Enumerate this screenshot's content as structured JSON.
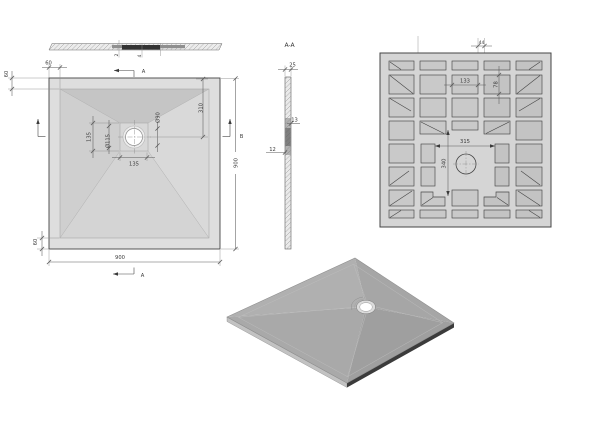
{
  "window": {
    "width": 600,
    "height": 424,
    "background": "#ffffff"
  },
  "colors": {
    "line": "#454545",
    "dim": "#5a5a5a",
    "face-plan": "#dedede",
    "slope-top": "#c5c5c5",
    "slope-left": "#cfcfcf",
    "slope-right": "#d9d9d9",
    "slope-bottom": "#d4d4d4",
    "flat": "#d8d8d8",
    "face-bottom": "#d5d5d5",
    "pocket": "#c9c9c9",
    "pocket-dark": "#c3c3c3",
    "iso-tl": "#b0b0b0",
    "iso-tr": "#a6a6a6",
    "iso-br": "#9f9f9f",
    "iso-bl": "#a9a9a9",
    "iso-edge-light": "#c2c2c2",
    "iso-edge-dark": "#3b3b3b"
  },
  "views": {
    "front_elevation": {
      "dims": {
        "step_left": "2",
        "step_right": "4"
      }
    },
    "plan": {
      "dims": {
        "margin": "60",
        "overall_width": "900",
        "overall_height": "900",
        "drain_from_top": "310",
        "flat_width": "135",
        "flat_height": "135",
        "recess_diameter": "Ø115",
        "drain_diameter": "Ø90"
      },
      "section_marks": {
        "a": "A",
        "b": "B"
      }
    },
    "section_aa": {
      "title": "A-A",
      "dims": {
        "edge_thickness": "25",
        "mid_thickness": "13",
        "base_thickness": "12"
      }
    },
    "bottom_view": {
      "dims": {
        "pocket_width": "133",
        "pocket_height": "78",
        "flat_width": "315",
        "flat_height": "340",
        "center_gap": "44"
      }
    }
  }
}
